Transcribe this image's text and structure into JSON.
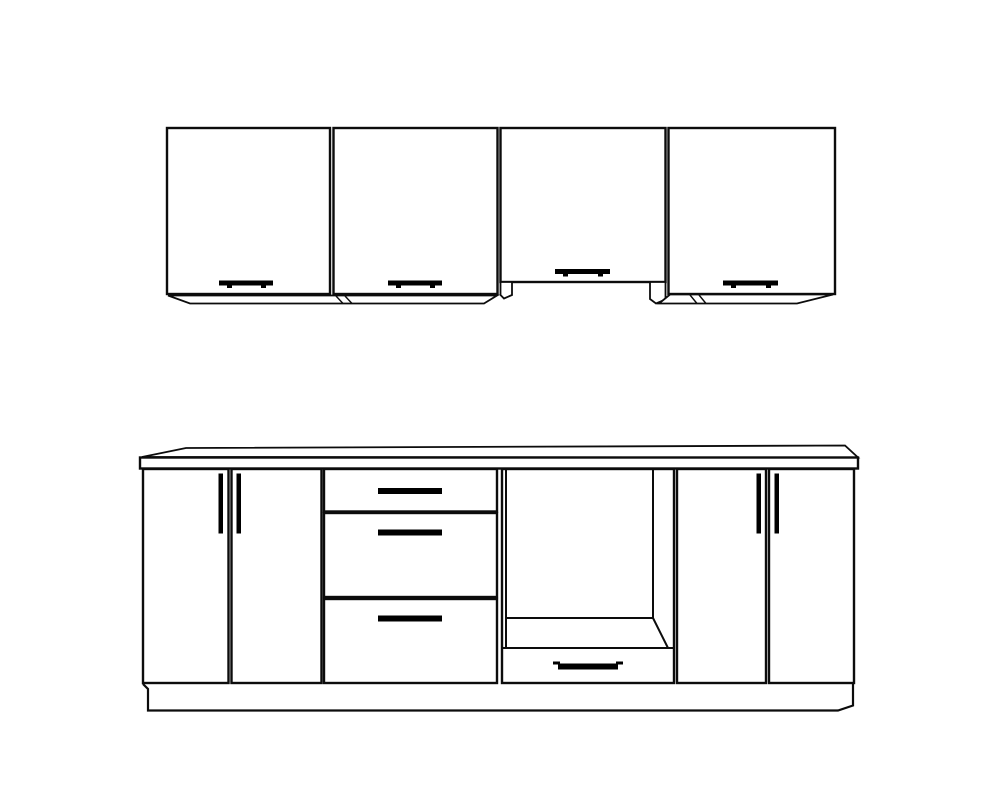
{
  "canvas": {
    "width": 1000,
    "height": 800,
    "colors": {
      "background": "#ffffff",
      "line": "#0c0c0c",
      "handle": "#000000"
    }
  },
  "diagram": {
    "type": "technical-line-drawing",
    "subject": "kitchen cabinet set, front elevation",
    "wall_row": {
      "cabinet_count": 4,
      "cabinets": [
        {
          "name": "wall-cabinet-1",
          "doors": 1,
          "handle": "horizontal-bar-bottom-center"
        },
        {
          "name": "wall-cabinet-2",
          "doors": 1,
          "handle": "horizontal-bar-bottom-center"
        },
        {
          "name": "wall-cabinet-3",
          "doors": 1,
          "handle": "horizontal-bar-bottom-center",
          "feature": "raised-bottom-hood-recess"
        },
        {
          "name": "wall-cabinet-4",
          "doors": 1,
          "handle": "horizontal-bar-bottom-center"
        }
      ]
    },
    "base_row": {
      "countertop": {
        "name": "countertop"
      },
      "plinth": {
        "name": "plinth-kickboard"
      },
      "units": [
        {
          "name": "base-cabinet-left",
          "doors": 2,
          "handles": "vertical-bars"
        },
        {
          "name": "drawer-unit",
          "drawers": 3,
          "handles": "horizontal-bars"
        },
        {
          "name": "oven-housing",
          "open_cavity": true,
          "bottom_drawer": 1,
          "handle": "horizontal-bar"
        },
        {
          "name": "base-cabinet-right",
          "doors": 2,
          "handles": "vertical-bars"
        }
      ]
    }
  }
}
